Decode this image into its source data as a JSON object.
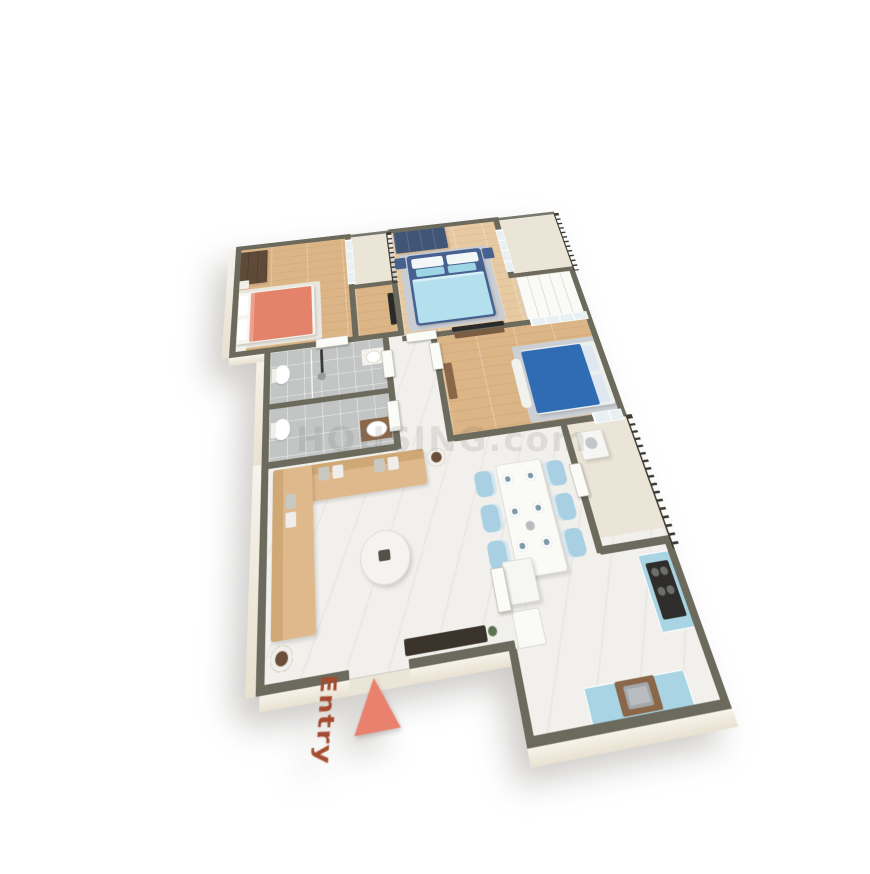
{
  "entry": {
    "label": "Entry"
  },
  "watermark": {
    "text": "HOUSING.com"
  },
  "icons": {
    "entry-arrow": "triangle-pointing-to-entry-door"
  },
  "colors": {
    "wall": "#6b6a5c",
    "wall_face": "#f3eee2",
    "wood": "#dcb587",
    "wood_light": "#e7c9a2",
    "tile": "#c2c5c4",
    "marble": "#f1f0ec",
    "balcony": "#ebe5d8",
    "bed_coral": "#e5826a",
    "bed_navy": "#46618f",
    "bedding_blue": "#b3e0ec",
    "pillow_blue": "#9fd6e6",
    "bed_bright": "#2f6cb3",
    "rug_gray": "#c9cdd4",
    "rug_light": "#e9e7df",
    "sofa": "#dfb98c",
    "sofa_dark": "#d0a876",
    "chair": "#a9cfe2",
    "counter": "#a8d4e4",
    "cooktop": "#2e2d2b",
    "wardrobe_brown": "#5f4a38",
    "wardrobe_blue": "#415577",
    "vanity_wood": "#8a6748",
    "railing": "#3e3c32",
    "door": "#fbfbf8",
    "glass": "#e8f0f2",
    "tv_dark": "#2a2a28",
    "arrow": "#e8826f",
    "entry_text": "#a34b2f",
    "watermark": "#787670"
  }
}
